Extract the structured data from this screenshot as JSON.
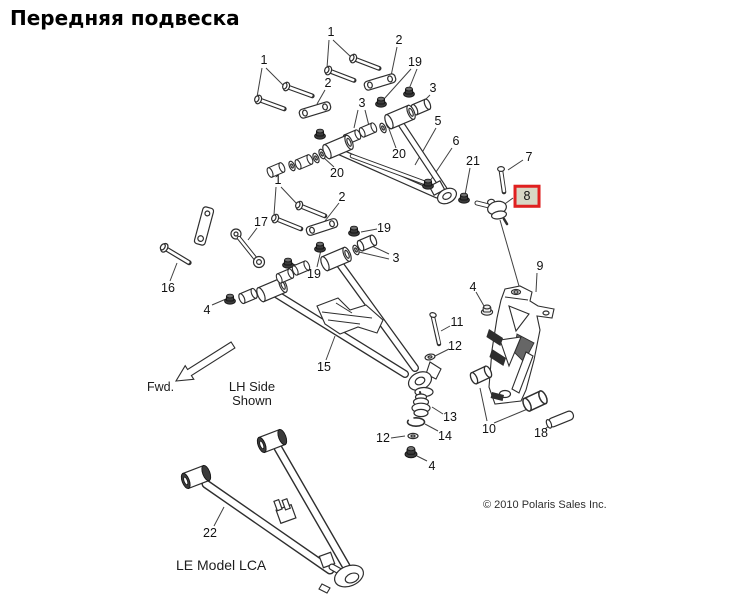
{
  "title": "Передняя подвеска",
  "diagram": {
    "highlight_color": "#e02020",
    "highlighted_part": "8",
    "notes": {
      "fwd": "Fwd.",
      "side_shown_line1": "LH Side",
      "side_shown_line2": "Shown",
      "model_variant": "LE Model LCA"
    },
    "copyright": "© 2010 Polaris Sales Inc.",
    "callouts": [
      {
        "label": "1",
        "x": 331,
        "y": 32
      },
      {
        "label": "1",
        "x": 264,
        "y": 60
      },
      {
        "label": "2",
        "x": 399,
        "y": 40
      },
      {
        "label": "19",
        "x": 415,
        "y": 62
      },
      {
        "label": "3",
        "x": 433,
        "y": 88
      },
      {
        "label": "2",
        "x": 328,
        "y": 83
      },
      {
        "label": "3",
        "x": 362,
        "y": 103
      },
      {
        "label": "5",
        "x": 438,
        "y": 121
      },
      {
        "label": "6",
        "x": 456,
        "y": 141
      },
      {
        "label": "21",
        "x": 473,
        "y": 161
      },
      {
        "label": "7",
        "x": 529,
        "y": 157
      },
      {
        "label": "20",
        "x": 399,
        "y": 154
      },
      {
        "label": "20",
        "x": 337,
        "y": 173
      },
      {
        "label": "8",
        "x": 527,
        "y": 196,
        "highlight": true
      },
      {
        "label": "1",
        "x": 278,
        "y": 180
      },
      {
        "label": "2",
        "x": 342,
        "y": 197
      },
      {
        "label": "17",
        "x": 261,
        "y": 222
      },
      {
        "label": "19",
        "x": 384,
        "y": 228
      },
      {
        "label": "19",
        "x": 314,
        "y": 274
      },
      {
        "label": "3",
        "x": 396,
        "y": 258
      },
      {
        "label": "16",
        "x": 168,
        "y": 288
      },
      {
        "label": "4",
        "x": 207,
        "y": 310
      },
      {
        "label": "15",
        "x": 324,
        "y": 367
      },
      {
        "label": "9",
        "x": 540,
        "y": 266
      },
      {
        "label": "4",
        "x": 473,
        "y": 287
      },
      {
        "label": "11",
        "x": 457,
        "y": 322
      },
      {
        "label": "12",
        "x": 455,
        "y": 346
      },
      {
        "label": "13",
        "x": 450,
        "y": 417
      },
      {
        "label": "14",
        "x": 445,
        "y": 436
      },
      {
        "label": "12",
        "x": 383,
        "y": 438
      },
      {
        "label": "4",
        "x": 432,
        "y": 466
      },
      {
        "label": "10",
        "x": 489,
        "y": 429
      },
      {
        "label": "18",
        "x": 541,
        "y": 433
      },
      {
        "label": "22",
        "x": 210,
        "y": 533
      }
    ]
  }
}
